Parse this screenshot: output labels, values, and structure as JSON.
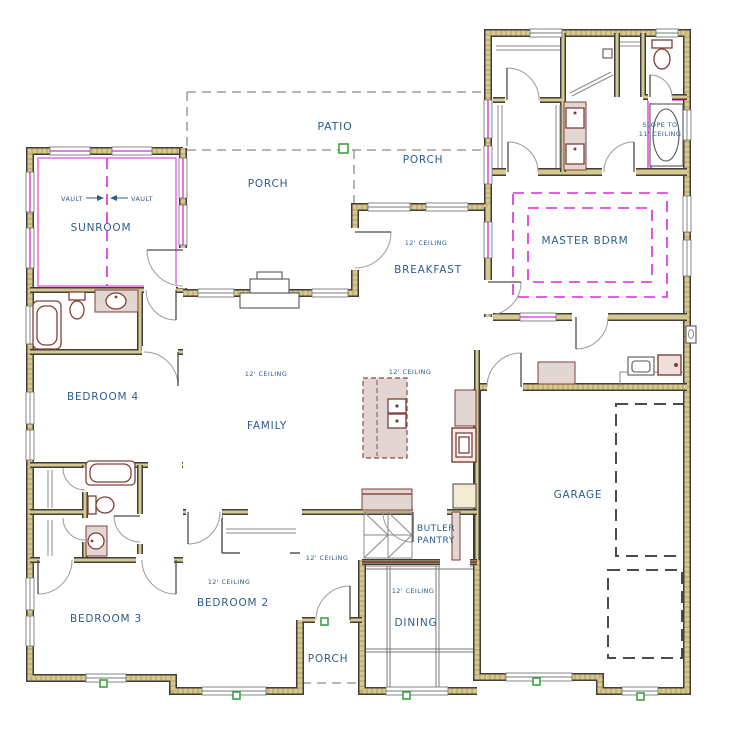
{
  "labels": {
    "patio": "PATIO",
    "porch": "PORCH",
    "sunroom": "SUNROOM",
    "vault": "VAULT",
    "breakfast": "BREAKFAST",
    "master": "MASTER BDRM",
    "slope1": "SLOPE TO",
    "slope2": "11' CEILING",
    "family": "FAMILY",
    "bedroom4": "BEDROOM 4",
    "bedroom3": "BEDROOM 3",
    "bedroom2": "BEDROOM 2",
    "butler1": "BUTLER",
    "butler2": "PANTRY",
    "dining": "DINING",
    "garage": "GARAGE",
    "ceiling_note": "12' CEILING"
  },
  "colors": {
    "wall_fill": "#d7c98e",
    "wall_edge": "#3d3d3d",
    "window_accent": "#d929d9",
    "ceiling_feature": "#d929d9",
    "label_text": "#2d5c8e",
    "post_marker": "#3fa23f",
    "fixture_outline": "#7d4038",
    "cabinet_fill": "#e2d6d2"
  }
}
